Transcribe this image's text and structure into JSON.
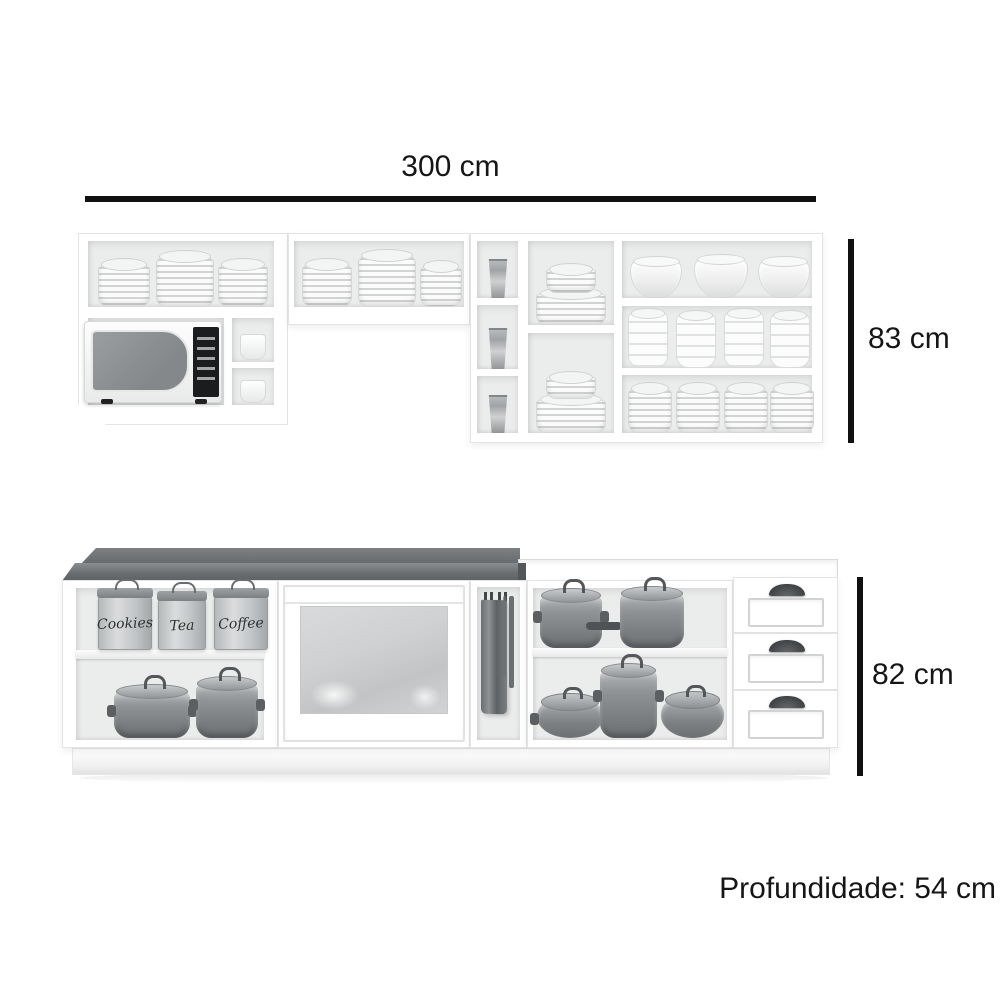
{
  "labels": {
    "width": "300 cm",
    "upper_height": "83 cm",
    "lower_height": "82 cm",
    "depth": "Profundidade: 54 cm"
  },
  "upper_cabinet": {
    "contents": [
      "plates",
      "bowls",
      "cups",
      "glasses",
      "microwave"
    ]
  },
  "lower_cabinet": {
    "canisters": [
      "Cookies",
      "Tea",
      "Coffee"
    ],
    "contents": [
      "canisters",
      "pots",
      "pans",
      "kitchen-towel",
      "frosted-glass-door",
      "drawers"
    ]
  },
  "colors": {
    "background": "#ffffff",
    "dimension_line": "#111111",
    "text": "#161616",
    "countertop_gray": "#6b6e71",
    "cabinet_white": "#ffffff",
    "interior_gray": "#ebecec",
    "cookware_gray": "#8f9395",
    "handle_dark": "#3f4245"
  }
}
